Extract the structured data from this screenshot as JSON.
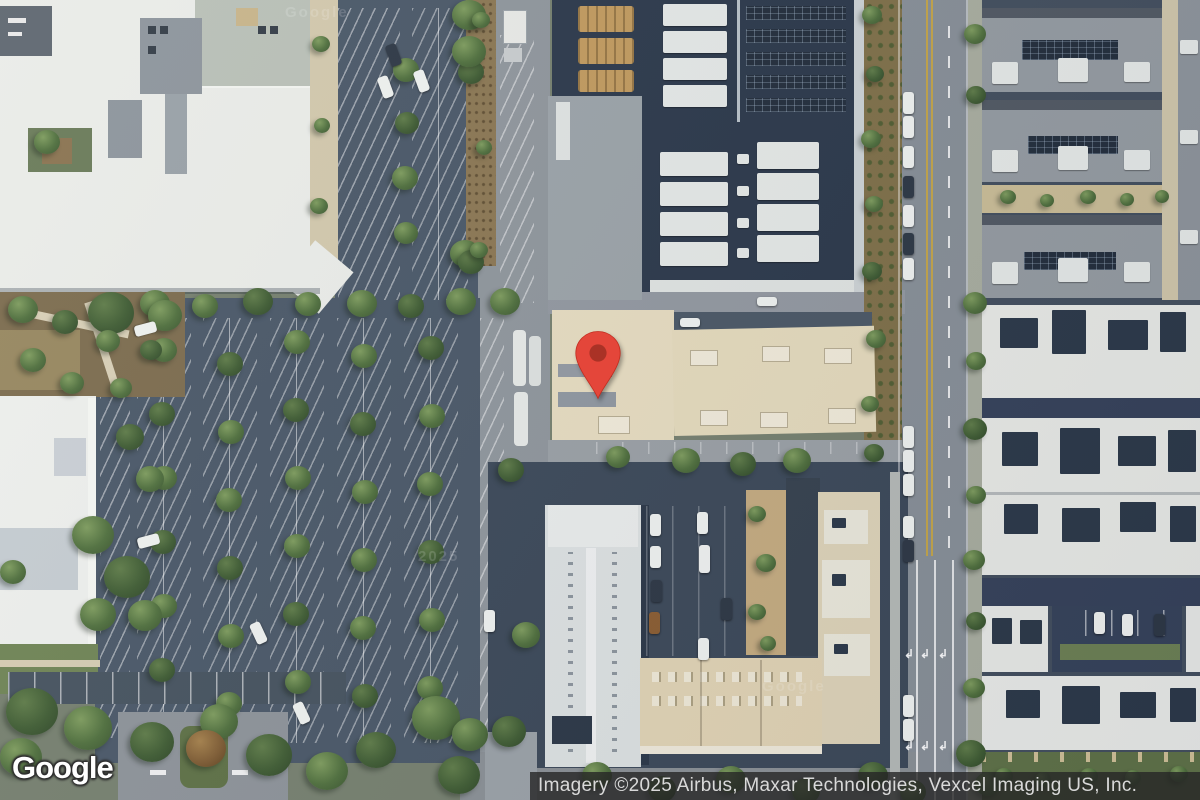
{
  "map": {
    "watermark_text": "Google",
    "watermark_year_text": "2025"
  },
  "marker": {
    "label": "location-pin",
    "fill_color": "#EA4335",
    "dot_color": "#AD2E20",
    "outline_color": "#C62718"
  },
  "branding": {
    "logo_text": "Google"
  },
  "attribution": {
    "text": "Imagery ©2025 Airbus, Maxar Technologies, Vexcel Imaging US, Inc.",
    "background_color": "#262626",
    "text_color": "#d9d9d9"
  },
  "road_markings": {
    "left_turn_arrow_glyph": "↲"
  }
}
